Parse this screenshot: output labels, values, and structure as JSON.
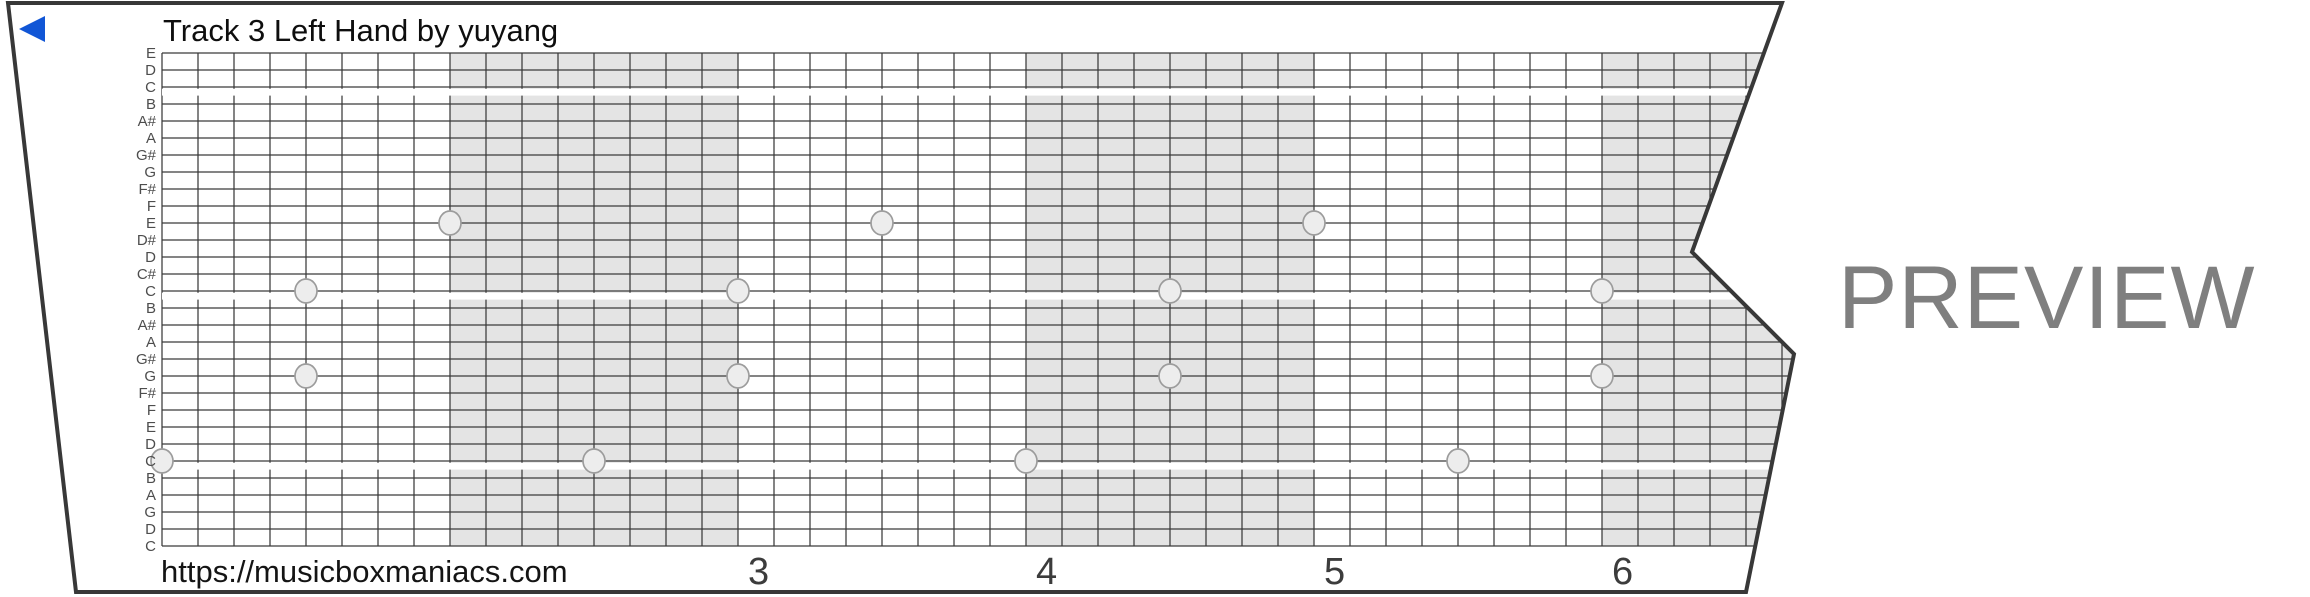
{
  "strip": {
    "title": "Track 3 Left Hand by yuyang"
  },
  "footer": {
    "url": "https://musicboxmaniacs.com"
  },
  "watermark": {
    "text": "PREVIEW"
  },
  "icons": {
    "back_marker": "left-triangle-icon"
  },
  "colors": {
    "paper": "#ffffff",
    "grid_line": "#3a3a3a",
    "outline": "#383838",
    "shaded_band": "#e4e4e4",
    "note_fill": "#ededed",
    "note_stroke": "#9c9c9c",
    "marker_blue": "#1156d6",
    "watermark_gray": "#7f7f7f",
    "label_gray": "#4d4d4d",
    "number_gray": "#3c3c3c"
  },
  "chart_data": {
    "type": "scatter",
    "description": "30-note music box punch strip; x = time in beats (8 beats per measure), y = pitch line",
    "note_rows": [
      "E",
      "D",
      "C",
      "B",
      "A#",
      "A",
      "G#",
      "G",
      "F#",
      "F",
      "E",
      "D#",
      "D",
      "C#",
      "C",
      "B",
      "A#",
      "A",
      "G#",
      "G",
      "F#",
      "F",
      "E",
      "D",
      "C",
      "B",
      "A",
      "G",
      "D",
      "C"
    ],
    "octave_separator_rows": [
      2,
      14,
      24
    ],
    "beats_per_measure": 8,
    "shaded_measure_indices": [
      1,
      3,
      5
    ],
    "visible_vertical_lines": 46,
    "measure_numbers": [
      {
        "label": "3",
        "measure_index": 2
      },
      {
        "label": "4",
        "measure_index": 3
      },
      {
        "label": "5",
        "measure_index": 4
      },
      {
        "label": "6",
        "measure_index": 5
      }
    ],
    "notes": [
      {
        "beat": 0,
        "row": 24,
        "pitch": "C"
      },
      {
        "beat": 4,
        "row": 14,
        "pitch": "C"
      },
      {
        "beat": 4,
        "row": 19,
        "pitch": "G"
      },
      {
        "beat": 8,
        "row": 10,
        "pitch": "E"
      },
      {
        "beat": 12,
        "row": 24,
        "pitch": "C"
      },
      {
        "beat": 16,
        "row": 14,
        "pitch": "C"
      },
      {
        "beat": 16,
        "row": 19,
        "pitch": "G"
      },
      {
        "beat": 20,
        "row": 10,
        "pitch": "E"
      },
      {
        "beat": 24,
        "row": 24,
        "pitch": "C"
      },
      {
        "beat": 28,
        "row": 14,
        "pitch": "C"
      },
      {
        "beat": 28,
        "row": 19,
        "pitch": "G"
      },
      {
        "beat": 32,
        "row": 10,
        "pitch": "E"
      },
      {
        "beat": 36,
        "row": 24,
        "pitch": "C"
      },
      {
        "beat": 40,
        "row": 14,
        "pitch": "C"
      },
      {
        "beat": 40,
        "row": 19,
        "pitch": "G"
      }
    ]
  }
}
